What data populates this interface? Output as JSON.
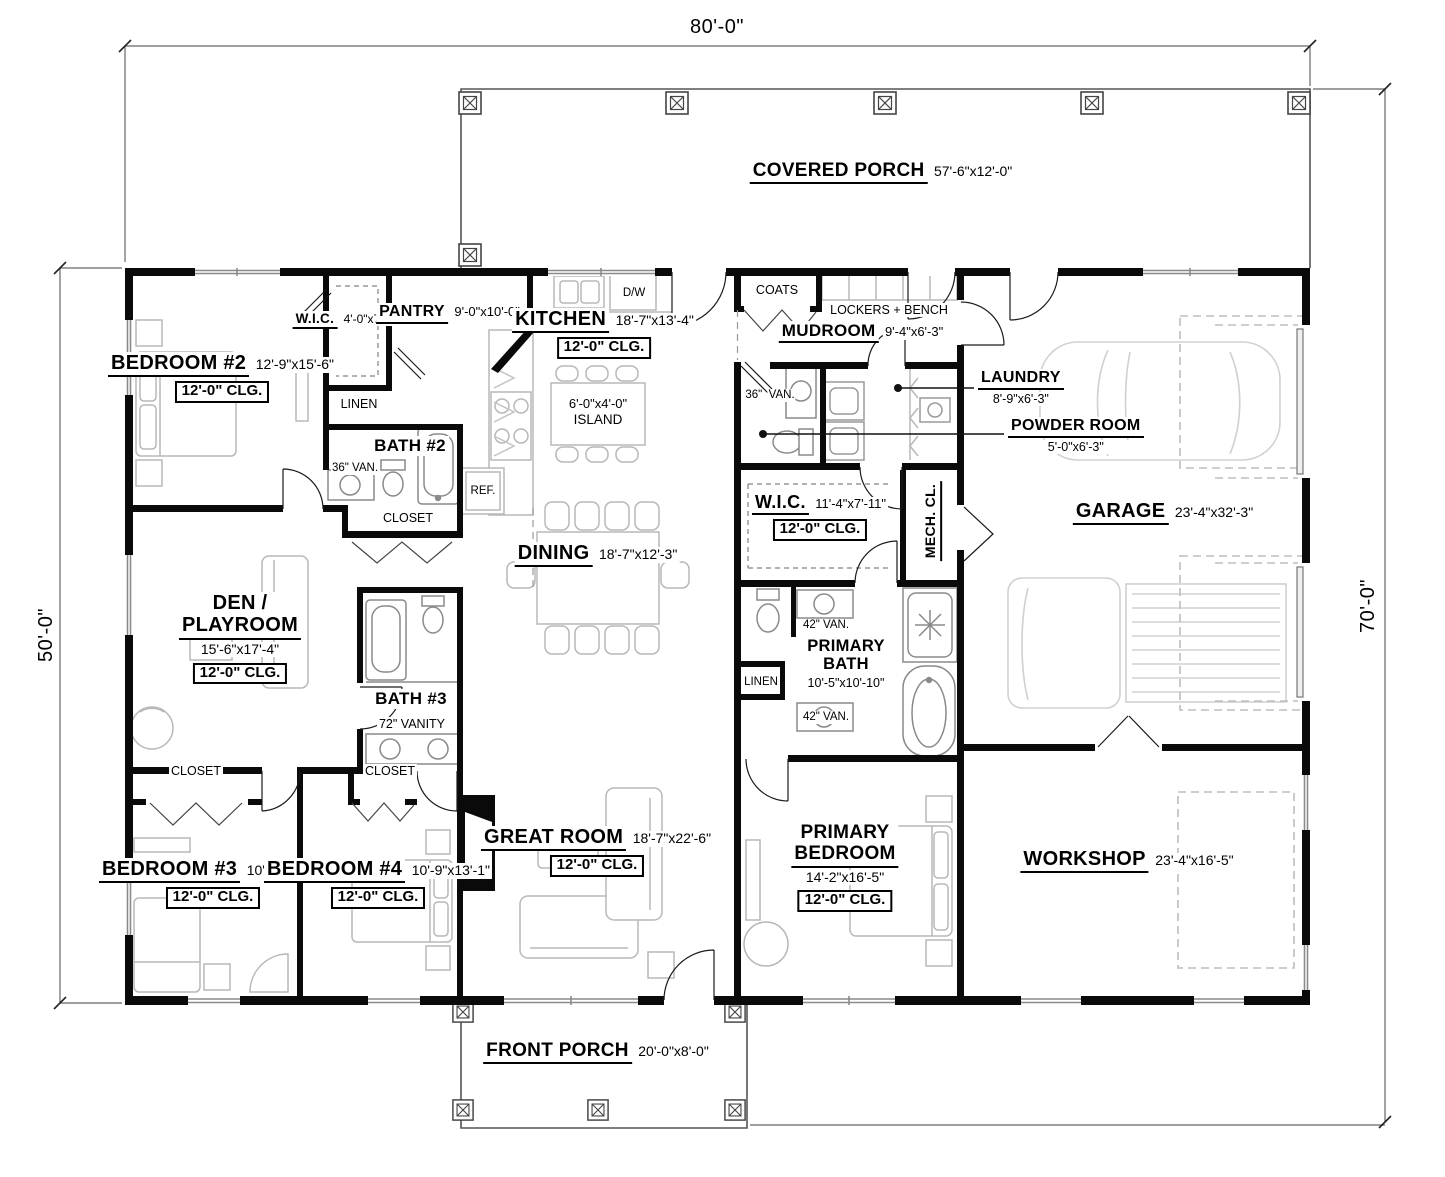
{
  "dimensions": {
    "top": "80'-0\"",
    "left": "50'-0\"",
    "right": "70'-0\""
  },
  "rooms": {
    "covered_porch": {
      "name": "COVERED PORCH",
      "dims": "57'-6\"x12'-0\""
    },
    "front_porch": {
      "name": "FRONT PORCH",
      "dims": "20'-0\"x8'-0\""
    },
    "bedroom2": {
      "name": "BEDROOM #2",
      "dims": "12'-9\"x15'-6\"",
      "clg": "12'-0\" CLG."
    },
    "wic_bedroom2": {
      "name": "W.I.C.",
      "dims": "4'-0\"x7'-7\""
    },
    "pantry": {
      "name": "PANTRY",
      "dims": "9'-0\"x10'-0\""
    },
    "kitchen": {
      "name": "KITCHEN",
      "dims": "18'-7\"x13'-4\"",
      "clg": "12'-0\" CLG."
    },
    "island": {
      "dims": "6'-0\"x4'-0\"",
      "label": "ISLAND"
    },
    "mudroom": {
      "name": "MUDROOM",
      "dims": "9'-4\"x6'-3\""
    },
    "laundry": {
      "name": "LAUNDRY",
      "dims": "8'-9\"x6'-3\""
    },
    "powder_room": {
      "name": "POWDER ROOM",
      "dims": "5'-0\"x6'-3\""
    },
    "garage": {
      "name": "GARAGE",
      "dims": "23'-4\"x32'-3\""
    },
    "bath2": {
      "name": "BATH #2"
    },
    "bath3": {
      "name": "BATH #3"
    },
    "wic_primary": {
      "name": "W.I.C.",
      "dims": "11'-4\"x7'-11\"",
      "clg": "12'-0\" CLG."
    },
    "mech_closet": {
      "name": "MECH. CL."
    },
    "dining": {
      "name": "DINING",
      "dims": "18'-7\"x12'-3\""
    },
    "den": {
      "name_line1": "DEN /",
      "name_line2": "PLAYROOM",
      "dims": "15'-6\"x17'-4\"",
      "clg": "12'-0\" CLG."
    },
    "primary_bath": {
      "name_line1": "PRIMARY",
      "name_line2": "BATH",
      "dims": "10'-5\"x10'-10\""
    },
    "primary_bedroom": {
      "name_line1": "PRIMARY",
      "name_line2": "BEDROOM",
      "dims": "14'-2\"x16'-5\"",
      "clg": "12'-0\" CLG."
    },
    "bedroom3": {
      "name": "BEDROOM #3",
      "dims": "10'-9\"x13'-1\"",
      "clg": "12'-0\" CLG."
    },
    "bedroom4": {
      "name": "BEDROOM #4",
      "dims": "10'-9\"x13'-1\"",
      "clg": "12'-0\" CLG."
    },
    "great_room": {
      "name": "GREAT ROOM",
      "dims": "18'-7\"x22'-6\"",
      "clg": "12'-0\" CLG."
    },
    "workshop": {
      "name": "WORKSHOP",
      "dims": "23'-4\"x16'-5\""
    }
  },
  "fixtures": {
    "coats": "COATS",
    "lockers_bench": "LOCKERS + BENCH",
    "linen_bedroom2": "LINEN",
    "linen_primary": "LINEN",
    "closet_bath2": "CLOSET",
    "closet_bedroom3": "CLOSET",
    "closet_bedroom4": "CLOSET",
    "refrigerator": "REF.",
    "dishwasher": "D/W",
    "vanity36_bath2": "36\" VAN.",
    "vanity36_powder_line1": "36\"",
    "vanity36_powder_line2": "VAN.",
    "vanity42_upper": "42\" VAN.",
    "vanity42_lower": "42\" VAN.",
    "vanity72": "72\" VANITY"
  },
  "colors": {
    "walls": "#0a0a0a",
    "text": "#000000",
    "furniture_outline": "#b8b8b8",
    "vehicle_outline": "#d0d0d0",
    "background": "#ffffff"
  }
}
